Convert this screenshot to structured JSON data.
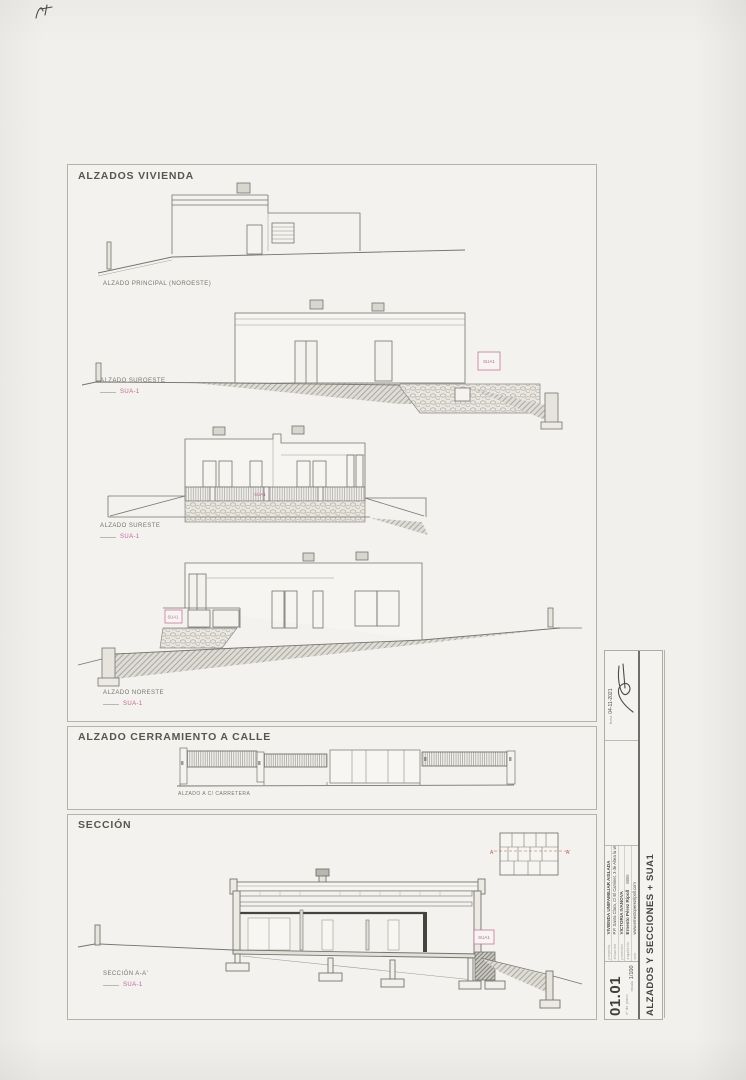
{
  "palette": {
    "paper": "#f1f0ec",
    "line": "#75746e",
    "pink": "#c0659a",
    "red": "#c4524e"
  },
  "sections": {
    "alzados_vivienda": {
      "title": "ALZADOS VIVIENDA"
    },
    "cerramiento": {
      "title": "ALZADO CERRAMIENTO A CALLE"
    },
    "seccion": {
      "title": "SECCIÓN"
    }
  },
  "labels": {
    "principal": {
      "name": "ALZADO PRINCIPAL (NOROESTE)"
    },
    "suroeste": {
      "name": "ALZADO SUROESTE",
      "ref": "SUA-1"
    },
    "sureste": {
      "name": "ALZADO SURESTE",
      "ref": "SUA-1"
    },
    "noreste": {
      "name": "ALZADO NORESTE",
      "ref": "SUA-1"
    },
    "calle": {
      "name": "ALZADO A C/ CARRETERA"
    },
    "seccion_aa": {
      "name": "SECCIÓN A-A'",
      "ref": "SUA-1"
    }
  },
  "tags": {
    "sua": "SUA1"
  },
  "key_plan": {
    "marker_left": "A",
    "marker_right": "A'"
  },
  "title_block": {
    "date_label": "fecha",
    "date": "04-11-2021",
    "rows": [
      {
        "label": "proyecto",
        "value": "VIVIENDA UNIFAMILIAR AISLADA"
      },
      {
        "label": "situación",
        "value": "P.P. Santa Clara, C/ El Caminet, 3 de Altea la vella (03599 Altea) (Alic)"
      },
      {
        "label": "promotor",
        "value": "VICTORIA IVANOVA"
      },
      {
        "label": "arquitecto",
        "value": "Ernesto Pérez Ripoll",
        "extra": "8856"
      },
      {
        "label": "web",
        "value": "www.ernestoperezripoll.com"
      }
    ],
    "sheet_title": "ALZADOS Y SECCIONES + SUA1",
    "sheet_number": "01.01",
    "sheet_number_caption": "nº de plano",
    "scale_label": "escala",
    "scale": "1/100"
  }
}
